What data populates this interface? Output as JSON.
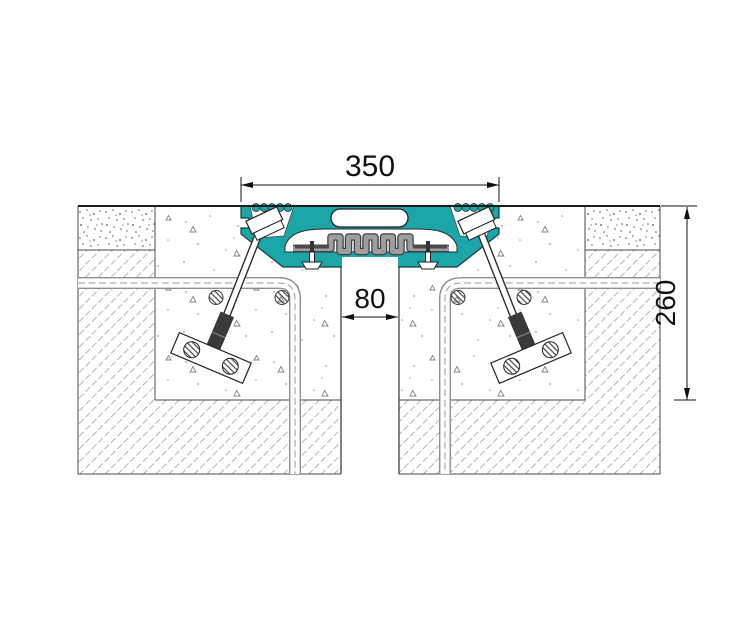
{
  "drawing": {
    "type": "expansion-joint-cross-section",
    "dimensions": {
      "joint_width": "350",
      "gap_width": "80",
      "recess_depth": "260"
    },
    "colors": {
      "profile": "#1ca6a8",
      "seal": "#9e9e9e",
      "concrete_hatch": "#b3b3b3",
      "line": "#1c1c1c"
    }
  }
}
